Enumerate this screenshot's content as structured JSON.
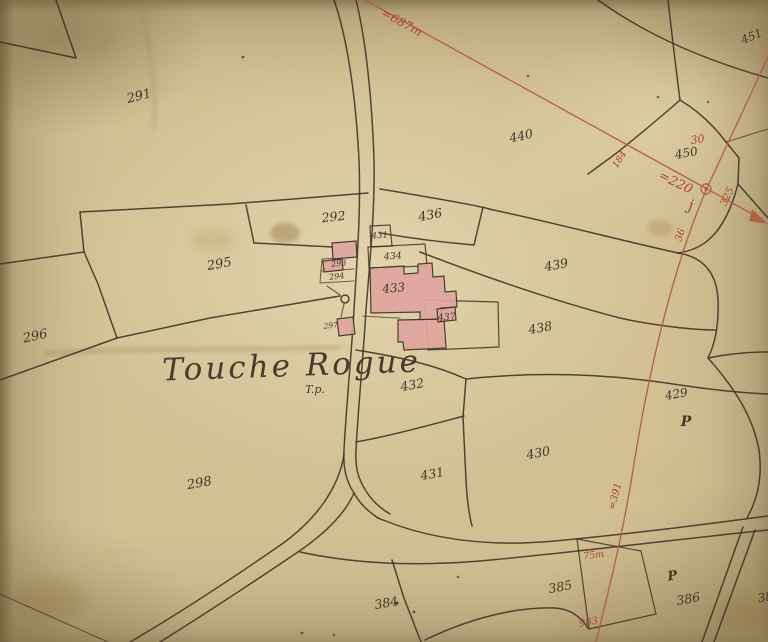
{
  "map": {
    "place_name": "Touche Rogue",
    "place_mark": "T.p.",
    "colors": {
      "paper": "#d2bf94",
      "ink": "#3c3226",
      "survey_red": "#b05a44",
      "red_text": "#a84232",
      "building_fill": "#e0a69f"
    },
    "parcel_labels": {
      "p291": "291",
      "p292": "292",
      "p293": "293",
      "p294": "294",
      "p295": "295",
      "p296": "296",
      "p297": "297",
      "p298": "298",
      "p384": "384",
      "p385": "385",
      "p386": "386",
      "p38_partial": "38",
      "p429": "429",
      "p430": "430",
      "p431": "431",
      "p431_small": "431",
      "p432": "432",
      "p433": "433",
      "p434": "434",
      "p436": "436",
      "p437": "437",
      "p438": "438",
      "p439": "439",
      "p440": "440",
      "p450": "450",
      "p451": "451",
      "letter_p_upper": "P",
      "letter_p_lower": "P"
    },
    "red_annotations": {
      "a687": "=687m",
      "a30": "30",
      "a220": "=220",
      "aj": "j",
      "a325": "325",
      "a36": "36",
      "a184": "184",
      "a391": "=391",
      "a75": "75m",
      "a983": "983"
    }
  }
}
